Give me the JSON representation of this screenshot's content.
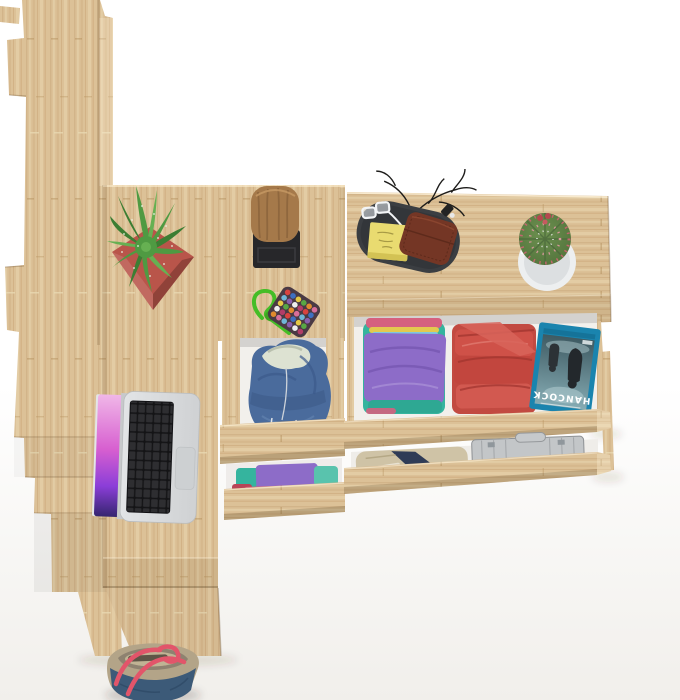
{
  "meta": {
    "description": "Top-down 3D product render: light Sonoma-oak bookcase tower, desk with laptop, drawer pedestal and chest of drawers with open drawers full of folded clothes, styled with plants and accessories on a white background",
    "background": "#ffffff"
  },
  "media": {
    "bluray_title": "HANCOCK"
  },
  "colors": {
    "wood": "#dcc197",
    "wood_light": "#e9d6b0",
    "wood_dark": "#c2a276",
    "drawer_interior": "#f2f0ec",
    "hoodie_blue": "#4a6b9c",
    "hoodie_lining": "#dde2d2",
    "shirt_purple": "#8d6cc8",
    "shirt_teal": "#35b49e",
    "shirt_pink": "#d5617f",
    "shirt_yellow": "#e3c94f",
    "stack_red": "#c24a41",
    "bluray_blue": "#1a84ae",
    "briefcase_silver": "#c3c6c8",
    "khaki": "#cfc3a6",
    "navy": "#2f3b56",
    "bag_blue": "#3c5a78",
    "bag_trim": "#b3a488",
    "bag_strap": "#e2556a",
    "pot_red": "#b9554a",
    "succulent_green": "#4f9a42",
    "cactus_green": "#5d8043",
    "cactus_pot": "#edeff0",
    "cactus_spines": "#c2666e",
    "cork": "#a5794a",
    "stand_black": "#27272a",
    "tray_gray": "#3b3e42",
    "note_yellow": "#e9db70",
    "wallet_brown": "#743625",
    "cord_green": "#45bd27",
    "laptop_body": "#d8dadc",
    "laptop_keys": "#2e2e31",
    "trackpad": "#cdd0d2",
    "screen_top": "#f0b7e8",
    "screen_mid": "#8b3ed8",
    "screen_bottom": "#35256f"
  },
  "objects": [
    {
      "id": "bookcase-tower",
      "label": "tall oak bookcase seen from above"
    },
    {
      "id": "desk",
      "label": "oak desk surface"
    },
    {
      "id": "drawer-pedestal",
      "label": "desk pedestal with two open drawers"
    },
    {
      "id": "dresser",
      "label": "oak chest of drawers with two open drawers"
    },
    {
      "id": "laptop",
      "label": "open silver laptop with pink wallpaper"
    },
    {
      "id": "potted-succulent",
      "label": "green succulent in red square pot"
    },
    {
      "id": "cork-stool",
      "label": "cork stump decor on black stand"
    },
    {
      "id": "bead-pouch",
      "label": "multicolour bead pouch with green cord"
    },
    {
      "id": "valet-tray",
      "label": "dark valet tray with wallet, sticky notes, glasses, twigs"
    },
    {
      "id": "cactus",
      "label": "ball cactus in round white pot"
    },
    {
      "id": "hoodie",
      "label": "blue hoodie stuffed in open drawer"
    },
    {
      "id": "folded-clothes",
      "label": "folded purple/teal and red shirt stacks"
    },
    {
      "id": "bluray",
      "label": "blue Blu-ray movie case"
    },
    {
      "id": "briefcase",
      "label": "aluminium briefcase inside drawer"
    },
    {
      "id": "tote-bag",
      "label": "blue canvas tote bag under the desk"
    }
  ]
}
